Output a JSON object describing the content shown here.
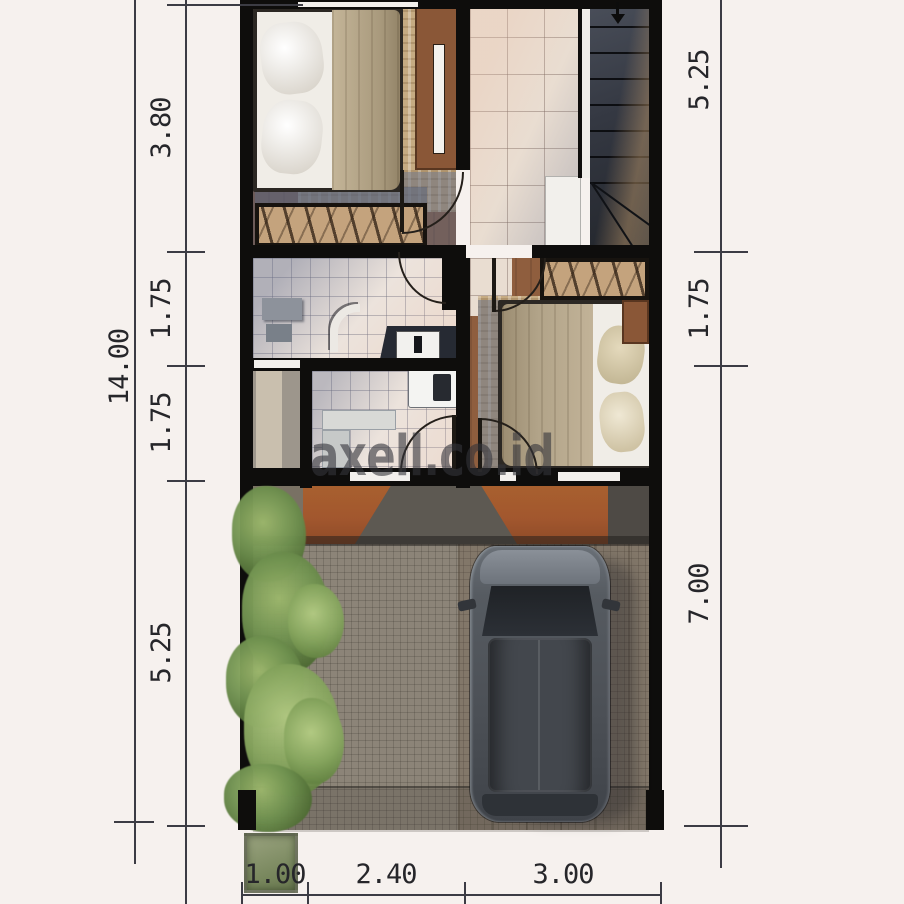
{
  "watermark": "axell.co.id",
  "dimensions": {
    "left_total": "14.00",
    "left": [
      "3.80",
      "1.75",
      "1.75",
      "5.25"
    ],
    "right": [
      "5.25",
      "1.75",
      "7.00"
    ],
    "bottom": [
      "1.00",
      "2.40",
      "3.00"
    ]
  },
  "icons": {
    "stairs_direction": "down-arrow"
  },
  "colors": {
    "background": "#f6f1ee",
    "wall": "#0e0d0c",
    "dimension_text": "#26262a",
    "wood_floor": "#8f5e3e",
    "rug": "#c6ab82",
    "hall_tile": "#e9ddd1",
    "bath_tile": "#ece3dc",
    "wardrobe_wood": "#c4a37d",
    "door_panel": "#8a5737",
    "stairs": "#3d424d",
    "roof_terracotta": "#a2572e",
    "roof_gray": "#5d5952",
    "pavement": "#8c8478",
    "foliage": "#6f914f",
    "car_body": "#54585e",
    "watermark": "#34343a"
  }
}
